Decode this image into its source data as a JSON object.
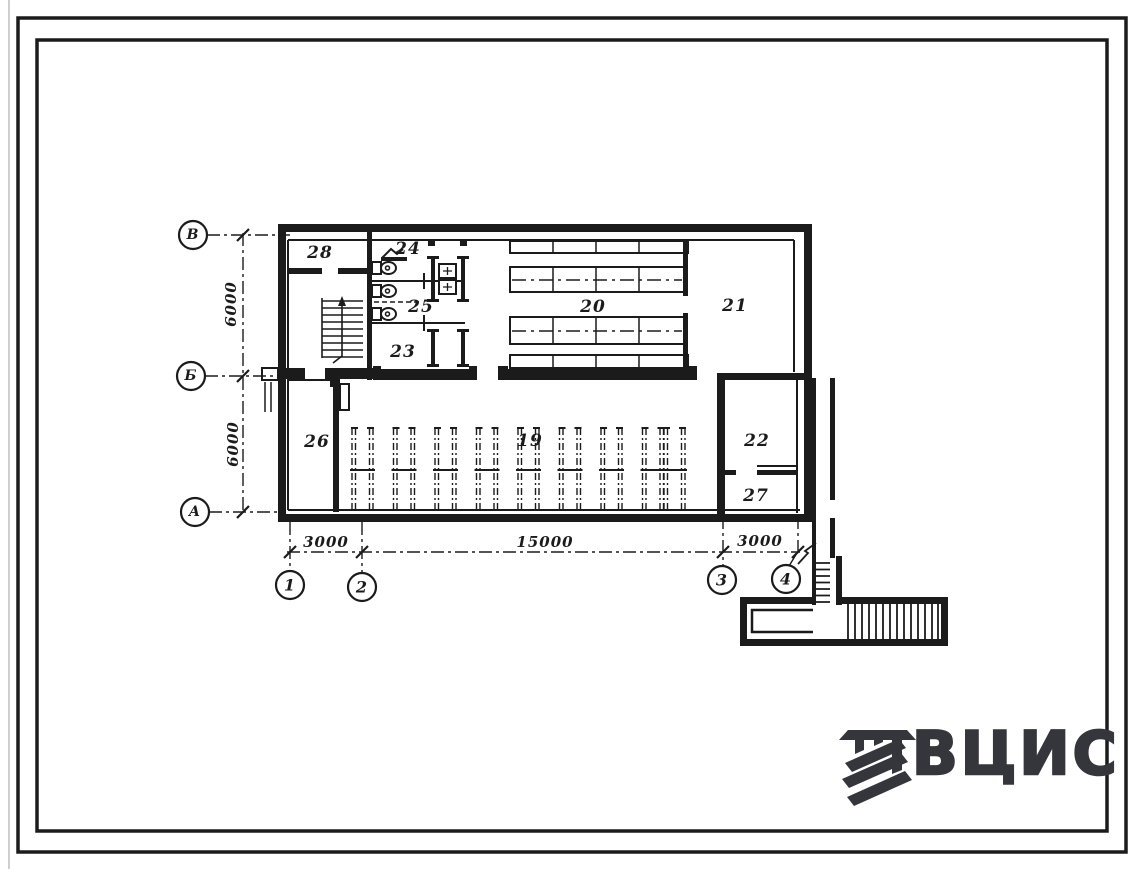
{
  "sheet": {
    "background": "#ffffff",
    "line_color": "#1b1b1b",
    "logo_color": "#35363c"
  },
  "plan": {
    "rooms": [
      {
        "id": "room-28",
        "label": "28"
      },
      {
        "id": "room-24",
        "label": "24"
      },
      {
        "id": "room-25",
        "label": "25"
      },
      {
        "id": "room-23",
        "label": "23"
      },
      {
        "id": "room-20",
        "label": "20"
      },
      {
        "id": "room-21",
        "label": "21"
      },
      {
        "id": "room-26",
        "label": "26"
      },
      {
        "id": "room-19",
        "label": "19"
      },
      {
        "id": "room-22",
        "label": "22"
      },
      {
        "id": "room-27",
        "label": "27"
      }
    ],
    "axis_rows": [
      {
        "label": "В"
      },
      {
        "label": "Б"
      },
      {
        "label": "А"
      }
    ],
    "axis_cols": [
      {
        "label": "1"
      },
      {
        "label": "2"
      },
      {
        "label": "3"
      },
      {
        "label": "4"
      }
    ],
    "dims": {
      "v_top": "6000",
      "v_bottom": "6000",
      "h_left": "3000",
      "h_mid": "15000",
      "h_right": "3000"
    }
  },
  "logo": {
    "text": "ВЦИС"
  }
}
